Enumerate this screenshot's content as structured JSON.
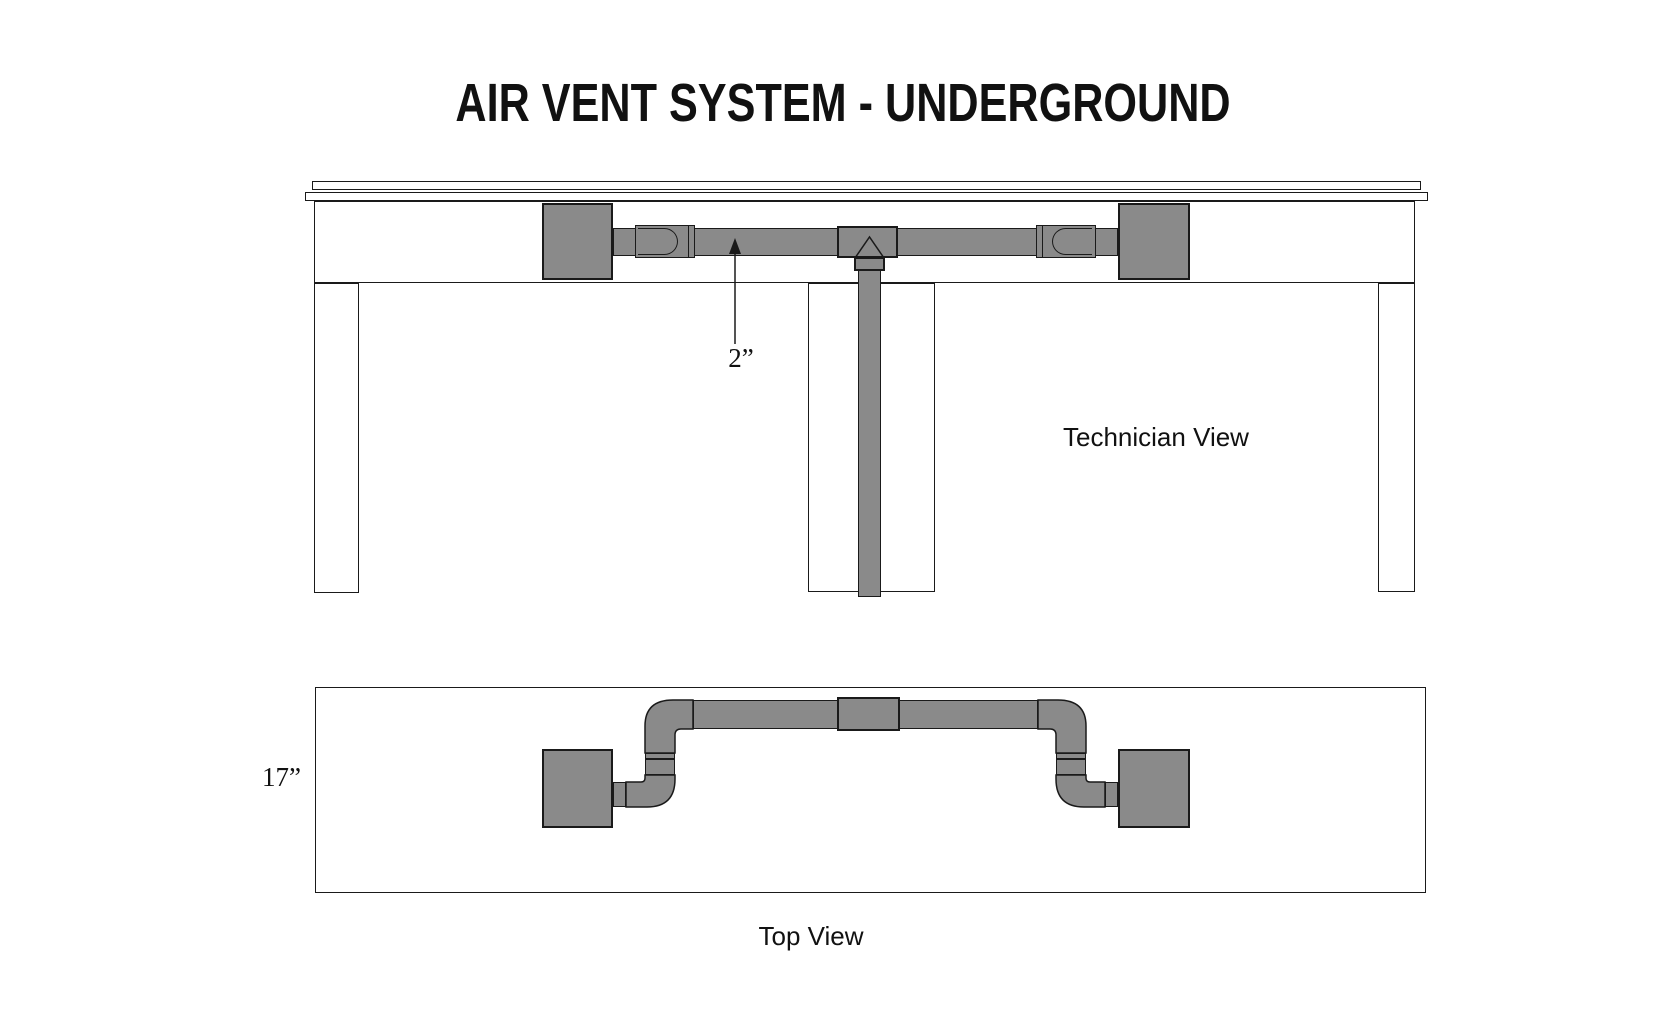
{
  "title": "AIR VENT SYSTEM - UNDERGROUND",
  "technician_view": {
    "label": "Technician View",
    "duct_diameter_label": "2”"
  },
  "top_view": {
    "label": "Top View",
    "depth_label": "17”"
  },
  "colors": {
    "duct_gray": "#8a8a8a",
    "line_black": "#1a1a1a",
    "background": "#ffffff"
  }
}
